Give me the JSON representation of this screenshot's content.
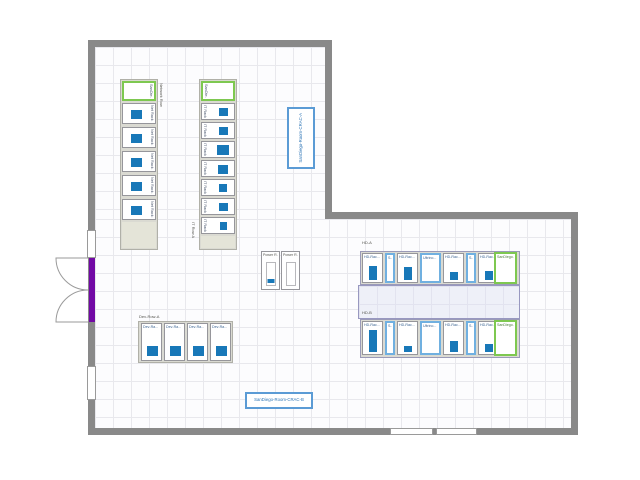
{
  "colors": {
    "wall": "#898989",
    "door": "#7209a5",
    "rack_utilization_blue": "#1878b8",
    "green_border": "#7ec850",
    "blue_border": "#70b0e0",
    "crac_border": "#5b9bd5",
    "crac_text": "#2e75b6",
    "aisle_fill": "#eef0f8",
    "zone_border": "#9898c0",
    "row_band_fill": "#dadad2"
  },
  "network_row": {
    "row_label": "Network Row",
    "head_label": "SanDie...",
    "racks": [
      {
        "label": "Net Rack 1"
      },
      {
        "label": "Net Rack 2"
      },
      {
        "label": "Net Rack 3"
      },
      {
        "label": "Net Rack 4"
      },
      {
        "label": "Net Rack 5"
      }
    ]
  },
  "it_row": {
    "row_label": "IT Row A",
    "head_label": "SanDie...",
    "racks": [
      {
        "label": "IT Rack 1"
      },
      {
        "label": "IT Rack 2"
      },
      {
        "label": "IT Rack 3"
      },
      {
        "label": "IT Rack 4"
      },
      {
        "label": "IT Rack 5"
      },
      {
        "label": "IT Rack 6"
      },
      {
        "label": "IT Rack 7"
      }
    ]
  },
  "power_row": {
    "racks": [
      {
        "label": "Power R...",
        "fill_px": 4
      },
      {
        "label": "Power R...",
        "fill_px": 0
      }
    ]
  },
  "dev_row": {
    "row_label": "Dev-Row-A",
    "racks": [
      {
        "label": "Dev-Ra..."
      },
      {
        "label": "Dev-Ra..."
      },
      {
        "label": "Dev-Ra..."
      },
      {
        "label": "Dev-Ra..."
      }
    ]
  },
  "hd_row_a": {
    "row_label": "HD-A",
    "racks": [
      {
        "label": "HD-Rac...",
        "fill_px": 14
      },
      {
        "label": "S...",
        "fill_px": 0
      },
      {
        "label": "HD-Rac...",
        "fill_px": 13
      },
      {
        "label": "Ultrino...",
        "fill_px": 0
      },
      {
        "label": "HD-Rac...",
        "fill_px": 8
      },
      {
        "label": "S...",
        "fill_px": 0
      },
      {
        "label": "HD-Rac...",
        "fill_px": 9
      },
      {
        "label": "SanDiego...",
        "fill_px": 0
      }
    ]
  },
  "hd_row_b": {
    "row_label": "HD-B",
    "racks": [
      {
        "label": "HD-Rac...",
        "fill_px": 22
      },
      {
        "label": "S...",
        "fill_px": 0
      },
      {
        "label": "HD-Rac...",
        "fill_px": 6
      },
      {
        "label": "Ultrino...",
        "fill_px": 0
      },
      {
        "label": "HD-Rac...",
        "fill_px": 11
      },
      {
        "label": "S...",
        "fill_px": 0
      },
      {
        "label": "HD-Rac...",
        "fill_px": 8
      },
      {
        "label": "SanDiego...",
        "fill_px": 0
      }
    ]
  },
  "crac_a": {
    "label": "SanDiego-Room-CRAC-A"
  },
  "crac_b": {
    "label": "SanDiego-Room-CRAC-B"
  }
}
